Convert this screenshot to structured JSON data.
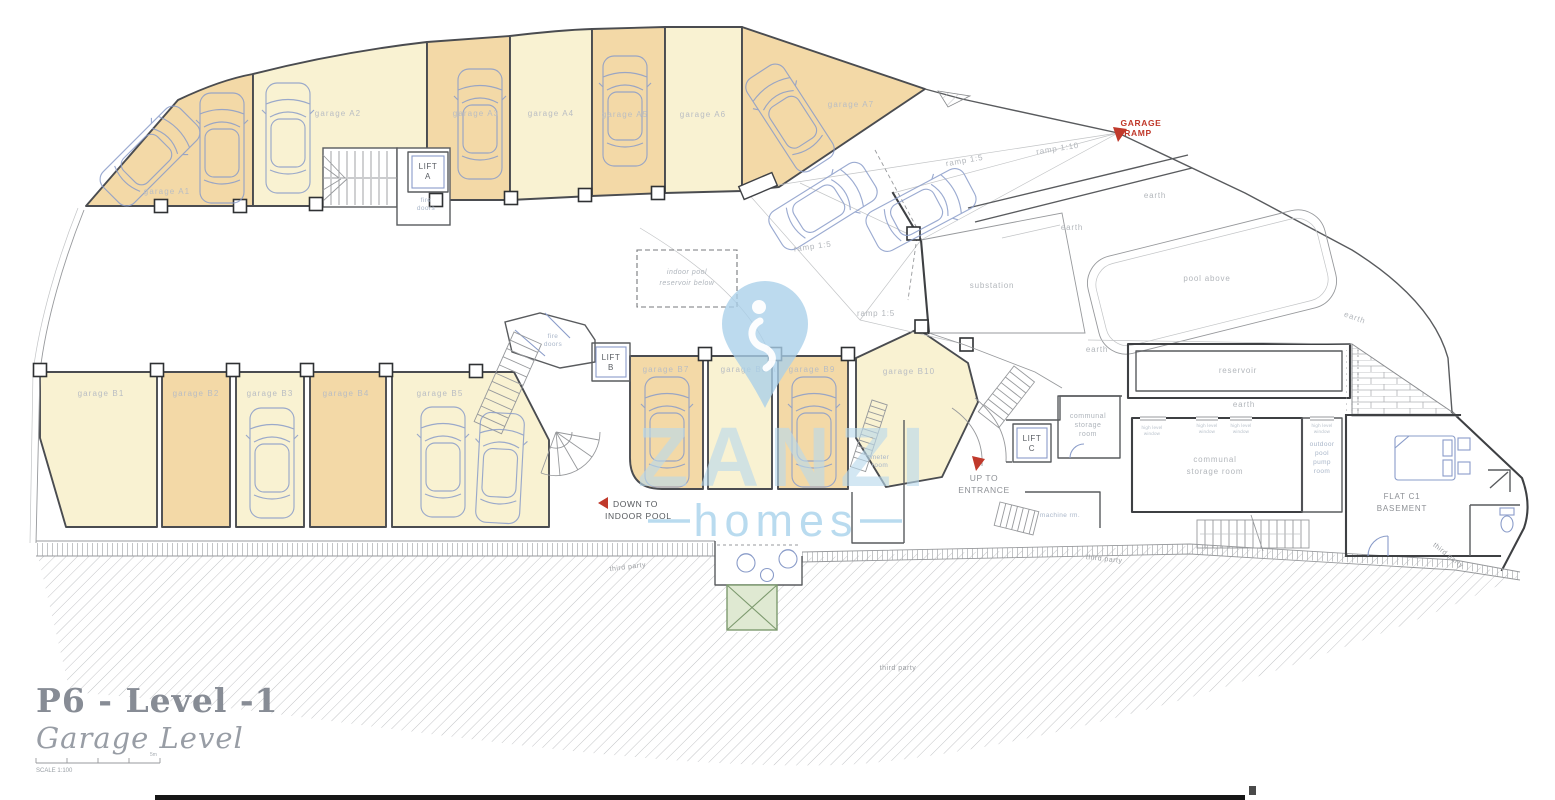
{
  "floor_plan": {
    "garages_a": [
      {
        "label": "garage A1"
      },
      {
        "label": "garage A2"
      },
      {
        "label": "garage A3"
      },
      {
        "label": "garage A4"
      },
      {
        "label": "garage A5"
      },
      {
        "label": "garage A6"
      },
      {
        "label": "garage A7"
      }
    ],
    "garages_b": [
      {
        "label": "garage B1"
      },
      {
        "label": "garage B2"
      },
      {
        "label": "garage B3"
      },
      {
        "label": "garage B4"
      },
      {
        "label": "garage B5"
      },
      {
        "label": "garage B7"
      },
      {
        "label": "garage B8"
      },
      {
        "label": "garage B9"
      },
      {
        "label": "garage B10"
      }
    ],
    "lifts": [
      {
        "line1": "LIFT",
        "line2": "A"
      },
      {
        "line1": "LIFT",
        "line2": "B"
      },
      {
        "line1": "LIFT",
        "line2": "C"
      }
    ],
    "rooms": {
      "fire_doors_line1": "fire",
      "fire_doors_line2": "doors",
      "substation": "substation",
      "pool_above": "pool above",
      "earth": "earth",
      "reservoir": "reservoir",
      "communal_small_line1": "communal",
      "communal_small_line2": "storage",
      "communal_small_line3": "room",
      "communal_large_line1": "communal",
      "communal_large_line2": "storage room",
      "high_level_window_line1": "high level",
      "high_level_window_line2": "window",
      "outdoor_pump_line1": "outdoor",
      "outdoor_pump_line2": "pool",
      "outdoor_pump_line3": "pump",
      "outdoor_pump_line4": "room",
      "flat_line1": "FLAT C1",
      "flat_line2": "BASEMENT",
      "machine_room": "machine rm.",
      "meter_line1": "meter",
      "meter_line2": "room",
      "indoor_pool_line1": "indoor pool",
      "indoor_pool_line2": "reservoir below",
      "third_party": "third party"
    },
    "ramps": {
      "ramp_1_5": "ramp 1:5",
      "ramp_1_10": "ramp 1:10"
    },
    "annotations": {
      "garage_ramp_line1": "GARAGE",
      "garage_ramp_line2": "RAMP",
      "down_line1": "DOWN TO",
      "down_line2": "INDOOR POOL",
      "up_line1": "UP TO",
      "up_line2": "ENTRANCE"
    }
  },
  "watermark": {
    "brand": "ZANZI",
    "tagline": "homes"
  },
  "title_block": {
    "title": "P6 - Level -1",
    "subtitle": "Garage Level",
    "scale_label": "SCALE 1:100",
    "scale_end": "5m"
  },
  "colors": {
    "garage_dark": "#f3d9a7",
    "garage_light": "#f9f2d2",
    "annotation_red": "#c0392b",
    "car_blue": "#8a9cc9",
    "watermark_blue": "#a9cfe9",
    "planter_green": "#dfe9d2"
  }
}
